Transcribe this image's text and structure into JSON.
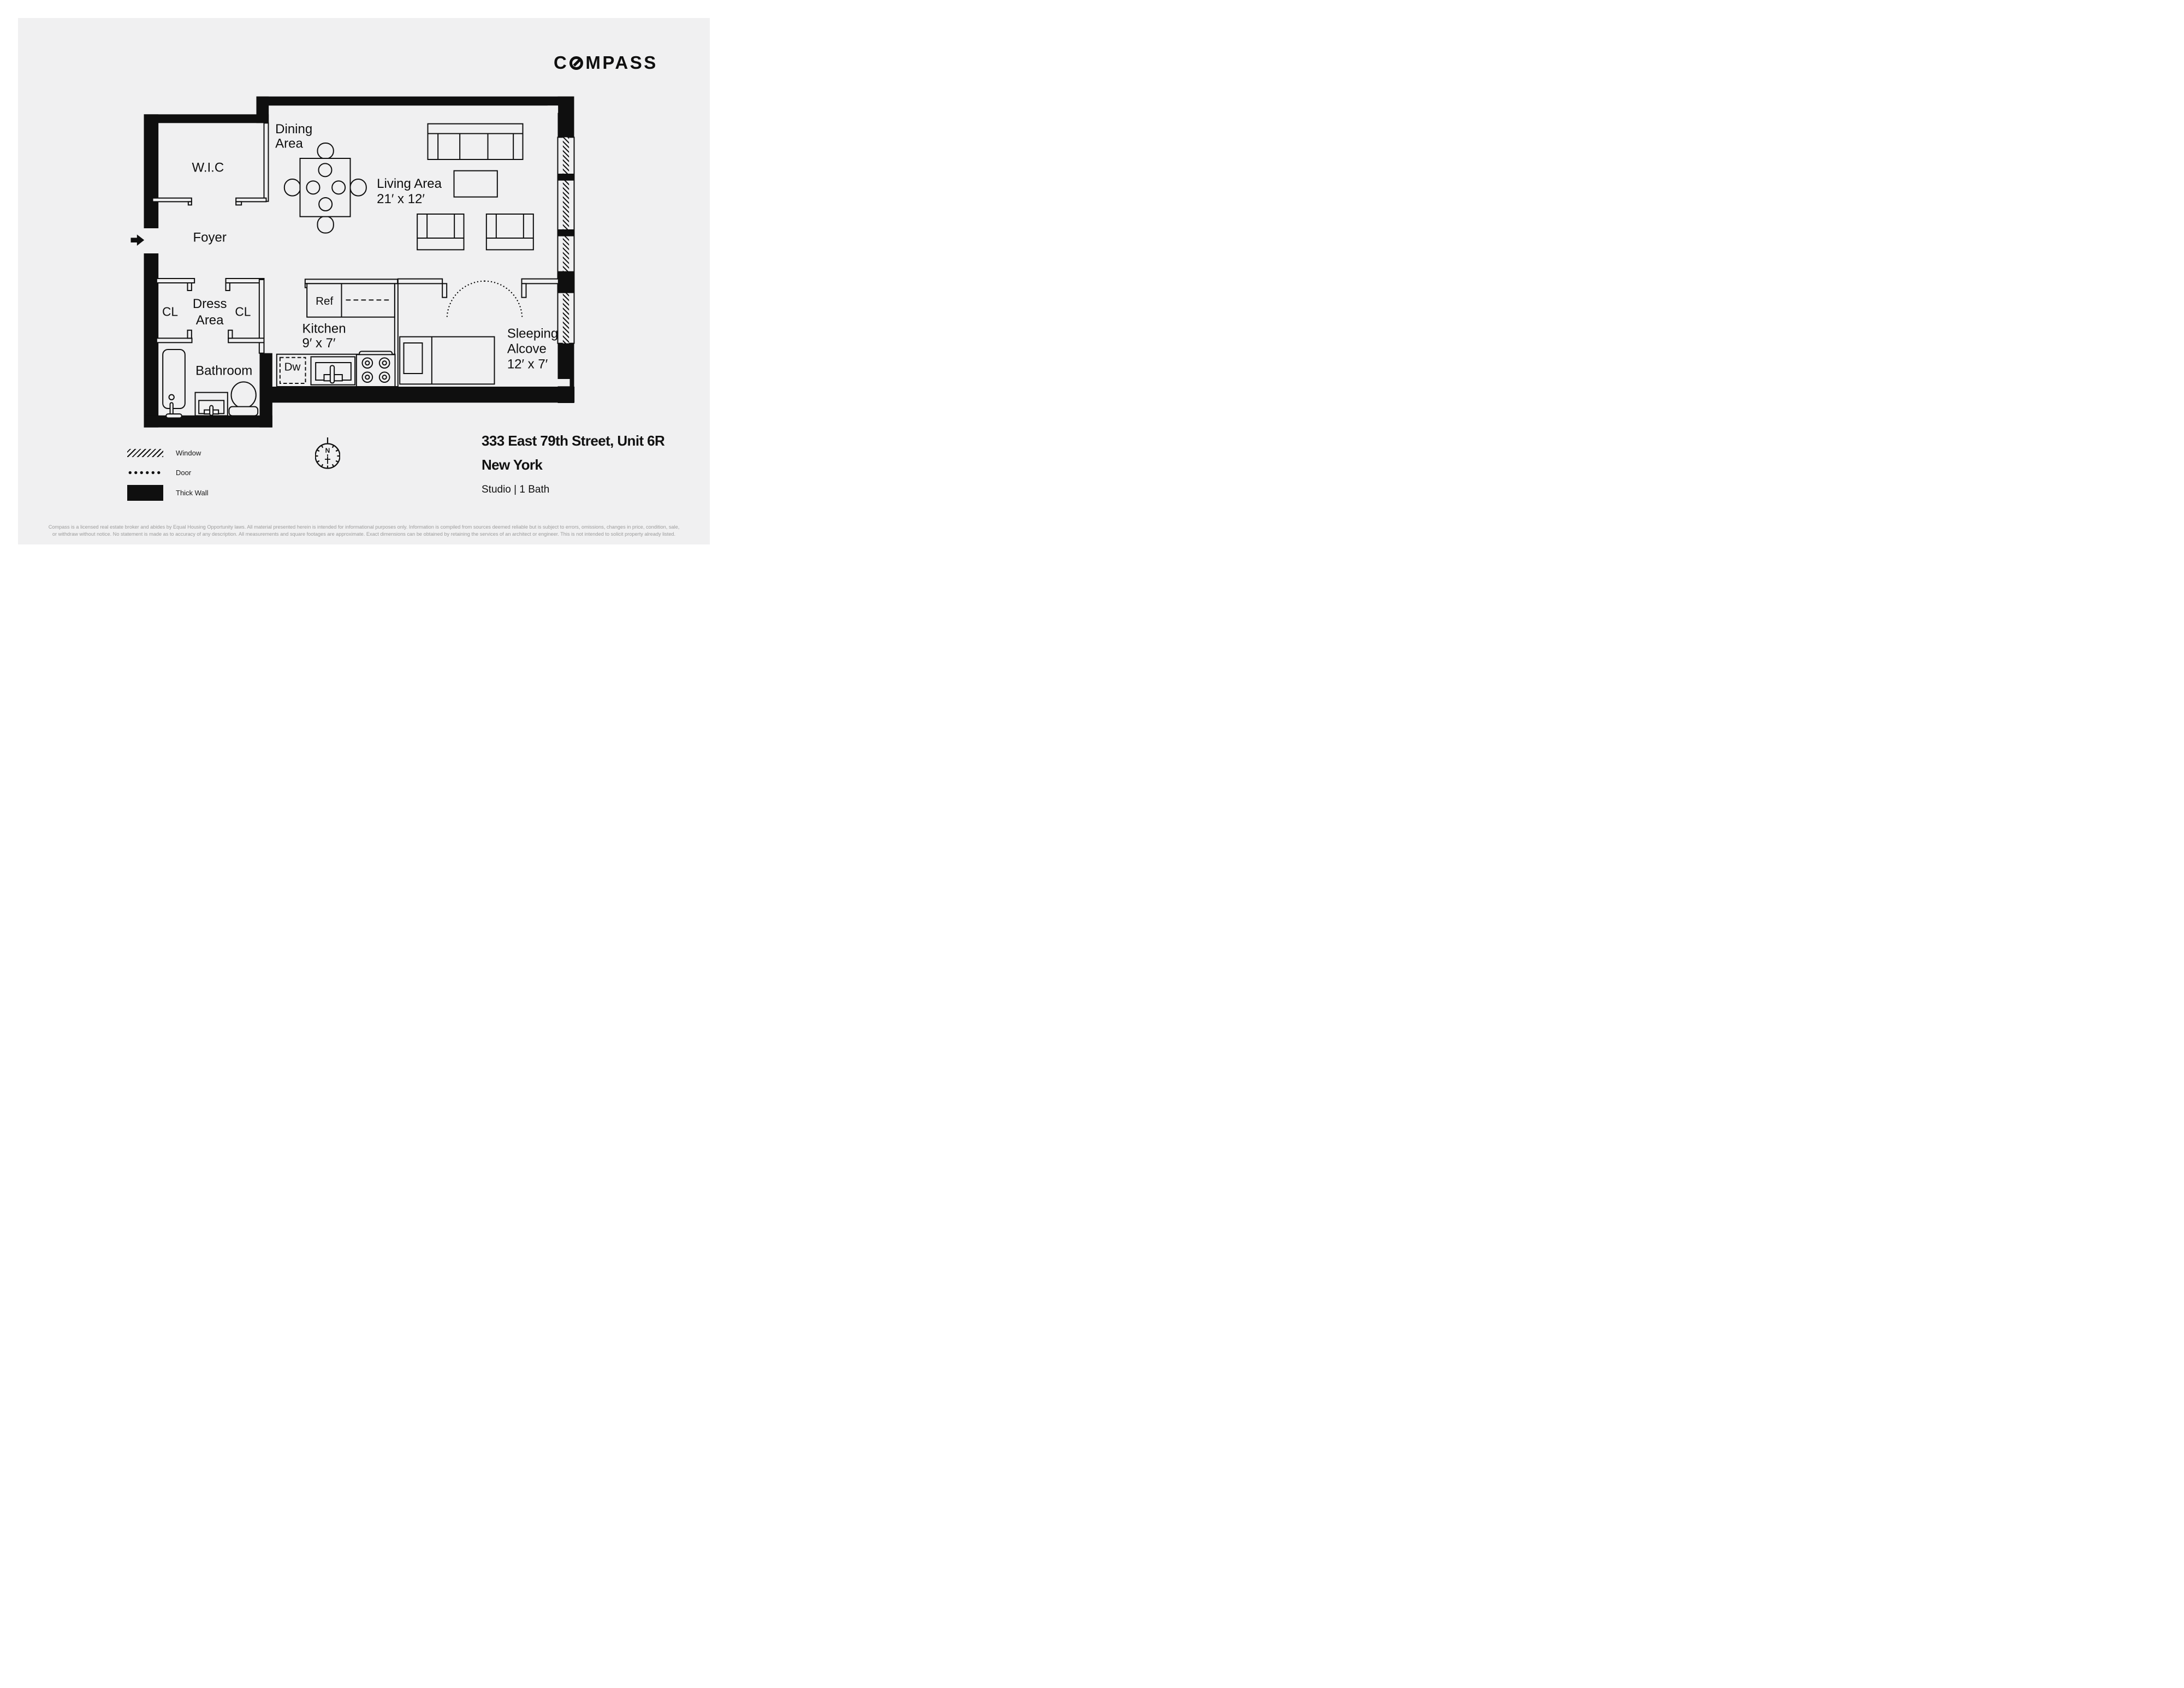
{
  "brand": {
    "prefix": "C",
    "suffix": "MPASS"
  },
  "plan": {
    "labels": {
      "wic": "W.I.C",
      "dining1": "Dining",
      "dining2": "Area",
      "living1": "Living Area",
      "living2": "21′ x 12′",
      "foyer": "Foyer",
      "cl_left": "CL",
      "cl_right": "CL",
      "dress1": "Dress",
      "dress2": "Area",
      "ref": "Ref",
      "dw": "Dw",
      "kitchen1": "Kitchen",
      "kitchen2": "9′ x 7′",
      "bathroom": "Bathroom",
      "sleeping1": "Sleeping",
      "sleeping2": "Alcove",
      "sleeping3": "12′ x 7′"
    }
  },
  "legend": {
    "window_label": "Window",
    "door_label": "Door",
    "wall_label": "Thick Wall"
  },
  "compass_rose": {
    "north": "N"
  },
  "listing": {
    "address_line": "333 East 79th Street, Unit 6R",
    "city": "New York",
    "details": "Studio | 1 Bath"
  },
  "footer": {
    "disclaimer_line1": "Compass is a licensed real estate broker and abides by Equal Housing Opportunity laws. All material presented herein is intended for informational purposes only. Information is compiled from sources deemed reliable but is subject to errors, omissions, changes in price, condition, sale,",
    "disclaimer_line2": "or withdraw without notice. No statement is made as to accuracy of any description. All measurements and square footages are approximate. Exact dimensions can be obtained by retaining the services of an architect or engineer. This is not intended to solicit property already listed."
  },
  "colors": {
    "ink": "#0f0f0f",
    "panel": "#f0f0f1",
    "muted_text": "#9c9c9c"
  }
}
